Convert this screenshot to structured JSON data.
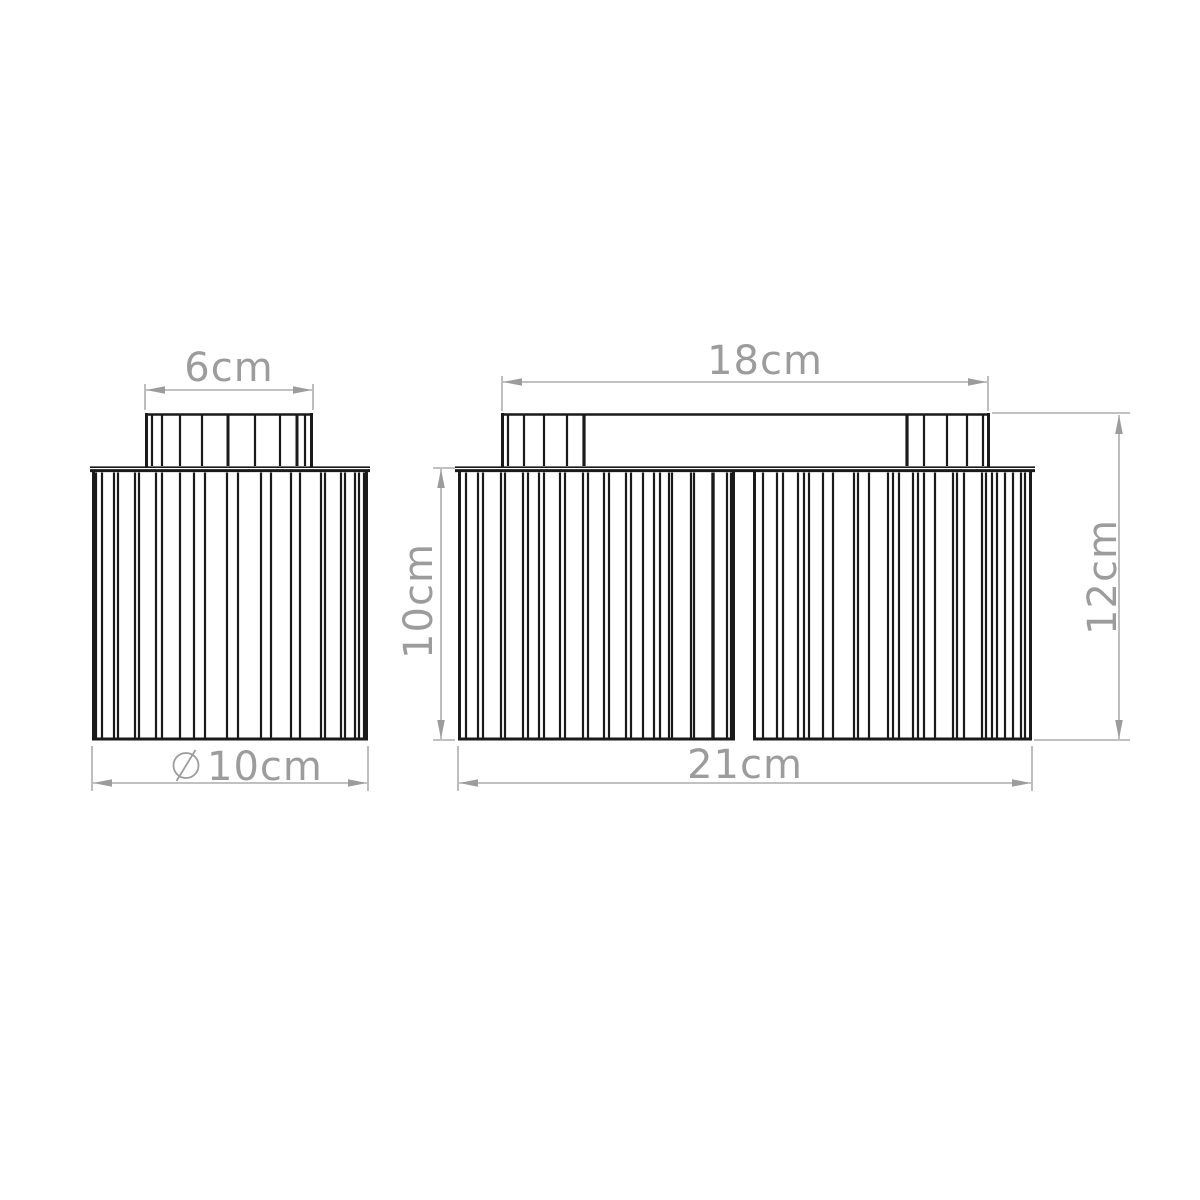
{
  "drawing": {
    "type": "technical-dimension-diagram",
    "subject": "fluted cylindrical ceiling lamps - front elevation, single-shade and double-shade versions",
    "units": "cm",
    "line_color": "#1a1a1a",
    "dimension_color": "#9c9c9c",
    "views": {
      "single_lamp": {
        "description": "one-shade ceiling lamp with fluted cap and fluted cylindrical shade",
        "cap_flutes": [
          [
            152,
            2.2
          ],
          [
            162,
            2.2
          ],
          [
            180,
            2.2
          ],
          [
            202,
            2.2
          ],
          [
            228,
            3
          ],
          [
            255,
            2.2
          ],
          [
            280,
            2.2
          ],
          [
            297,
            3
          ],
          [
            305,
            2.2
          ]
        ],
        "body_flutes": [
          96,
          102,
          114,
          118,
          135,
          139,
          156,
          162,
          180,
          194,
          205,
          227,
          238,
          261,
          271,
          291,
          300,
          321,
          325,
          341,
          345,
          355,
          359,
          364
        ],
        "dimensions": {
          "cap_width": "6cm",
          "diameter_symbol": "⌀",
          "diameter_value": "10cm"
        }
      },
      "double_lamp": {
        "description": "two-shade ceiling lamp hanging from a fluted oval canopy",
        "canopy_left_flutes": [
          [
            508,
            2.2
          ],
          [
            524,
            2.2
          ],
          [
            544,
            2.2
          ],
          [
            567,
            2.2
          ],
          [
            584,
            3.2
          ]
        ],
        "canopy_right_flutes": [
          [
            907,
            3.2
          ],
          [
            924,
            2.2
          ],
          [
            947,
            2.2
          ],
          [
            967,
            2.2
          ],
          [
            983,
            2.2
          ]
        ],
        "left_shade_flutes": [
          466,
          478,
          483,
          501,
          505,
          523,
          528,
          539,
          544,
          560,
          565,
          583,
          588,
          604,
          609,
          626,
          631,
          643,
          654,
          660,
          669,
          672,
          691,
          694,
          [
            713,
            3.4
          ],
          727,
          731
        ],
        "right_shade_flutes": [
          763,
          777,
          783,
          798,
          804,
          809,
          823,
          833,
          854,
          858,
          869,
          888,
          893,
          899,
          913,
          918,
          924,
          935,
          953,
          957,
          964,
          982,
          986,
          992,
          997,
          1005,
          1013,
          1021,
          1025
        ],
        "dimensions": {
          "canopy_width": "18cm",
          "overall_height": "12cm",
          "shade_height": "10cm",
          "overall_width": "21cm"
        }
      }
    }
  }
}
